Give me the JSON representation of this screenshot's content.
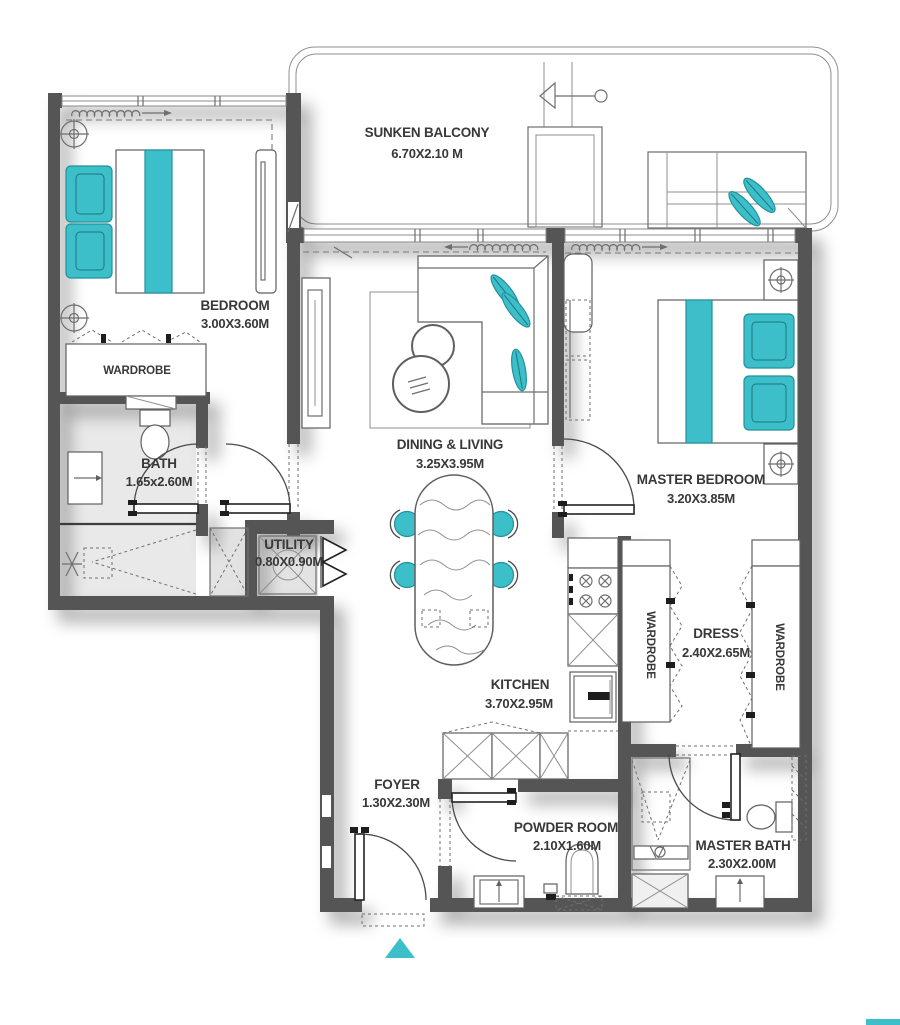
{
  "colors": {
    "teal": "#3cbfc9",
    "wall_gray": "#545454",
    "line_gray": "#6e6e6e",
    "label_text": "#383838"
  },
  "rooms": {
    "sunken_balcony": {
      "name": "SUNKEN BALCONY",
      "dims": "6.70X2.10 M"
    },
    "bedroom": {
      "name": "BEDROOM",
      "dims": "3.00X3.60M"
    },
    "bedroom_wardrobe": {
      "name": "WARDROBE"
    },
    "bath": {
      "name": "BATH",
      "dims": "1.65x2.60M"
    },
    "utility": {
      "name": "UTILITY",
      "dims": "0.80X0.90M"
    },
    "dining_living": {
      "name": "DINING & LIVING",
      "dims": "3.25X3.95M"
    },
    "master_bedroom": {
      "name": "MASTER BEDROOM",
      "dims": "3.20X3.85M"
    },
    "kitchen": {
      "name": "KITCHEN",
      "dims": "3.70X2.95M"
    },
    "foyer": {
      "name": "FOYER",
      "dims": "1.30X2.30M"
    },
    "powder_room": {
      "name": "POWDER ROOM",
      "dims": "2.10X1.60M"
    },
    "master_bath": {
      "name": "MASTER BATH",
      "dims": "2.30X2.00M"
    },
    "dress": {
      "name": "DRESS",
      "dims": "2.40X2.65M"
    },
    "dress_wardrobe_left": {
      "name": "WARDROBE"
    },
    "dress_wardrobe_right": {
      "name": "WARDROBE"
    }
  }
}
